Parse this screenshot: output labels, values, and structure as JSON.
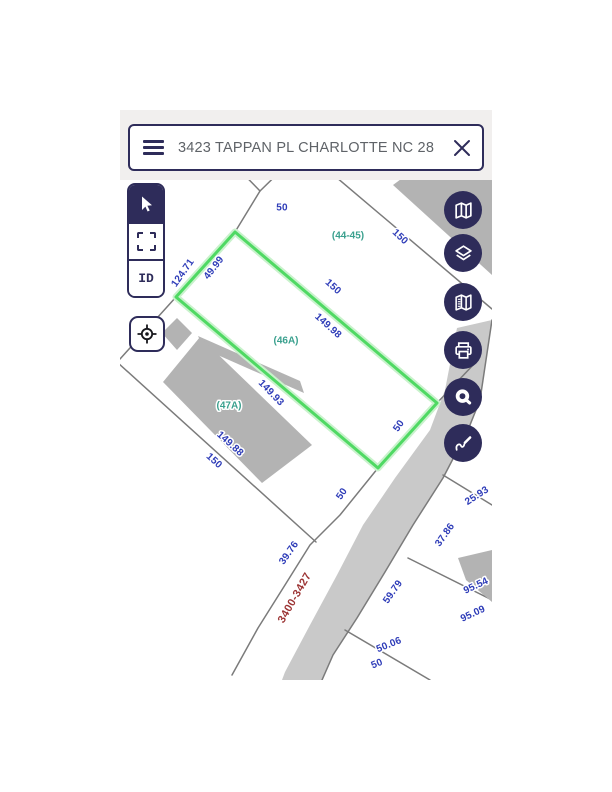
{
  "search_bar": {
    "query": "3423 TAPPAN PL CHARLOTTE NC 28",
    "menu_icon": "hamburger-icon",
    "clear_icon": "x-close-icon"
  },
  "toolbar": {
    "id_label": "ID",
    "tools": [
      "pointer-tool",
      "marquee-select-tool",
      "identify-tool",
      "locate-tool"
    ]
  },
  "map_buttons": [
    "map",
    "layers",
    "basemap",
    "print",
    "measure",
    "sketch"
  ],
  "map": {
    "colors": {
      "accent": "#2e2c5a",
      "header_bg": "#f1efee",
      "search_text": "#5f6368",
      "line": "#7b7b7b",
      "road": "#c9c9c9",
      "building": "#b3b3b3",
      "highlight": "#4fd963",
      "highlight_halo": "#c9f2cc",
      "dim": "#2e3cb8",
      "parcel": "#3aa08e",
      "street": "#9c3434"
    },
    "labels": {
      "dimensions": [
        {
          "text": "50",
          "x": 162,
          "y": 28,
          "rot": 0
        },
        {
          "text": "150",
          "x": 280,
          "y": 57,
          "rot": 43
        },
        {
          "text": "124.71",
          "x": 63,
          "y": 93,
          "rot": -55
        },
        {
          "text": "49.99",
          "x": 94,
          "y": 88,
          "rot": -52
        },
        {
          "text": "150",
          "x": 213,
          "y": 107,
          "rot": 42
        },
        {
          "text": "149.98",
          "x": 208,
          "y": 146,
          "rot": 42
        },
        {
          "text": "149.93",
          "x": 151,
          "y": 213,
          "rot": 46
        },
        {
          "text": "149.88",
          "x": 110,
          "y": 264,
          "rot": 42
        },
        {
          "text": "150",
          "x": 94,
          "y": 281,
          "rot": 42
        },
        {
          "text": "50",
          "x": 279,
          "y": 246,
          "rot": -55
        },
        {
          "text": "50",
          "x": 222,
          "y": 314,
          "rot": -55
        },
        {
          "text": "39.76",
          "x": 169,
          "y": 373,
          "rot": -55
        },
        {
          "text": "25.93",
          "x": 357,
          "y": 316,
          "rot": -33
        },
        {
          "text": "37.86",
          "x": 325,
          "y": 355,
          "rot": -55
        },
        {
          "text": "59.79",
          "x": 273,
          "y": 412,
          "rot": -55
        },
        {
          "text": "95.54",
          "x": 356,
          "y": 406,
          "rot": -25
        },
        {
          "text": "95.09",
          "x": 353,
          "y": 434,
          "rot": -25
        },
        {
          "text": "50.06",
          "x": 269,
          "y": 465,
          "rot": -22
        },
        {
          "text": "50",
          "x": 257,
          "y": 484,
          "rot": -22
        }
      ],
      "parcels": [
        {
          "text": "(44-45)",
          "x": 228,
          "y": 56
        },
        {
          "text": "(46A)",
          "x": 166,
          "y": 161
        },
        {
          "text": "(47A)",
          "x": 109,
          "y": 226
        }
      ],
      "street": {
        "text": "3400-3427",
        "x": 175,
        "y": 418,
        "rot": -60
      }
    }
  }
}
